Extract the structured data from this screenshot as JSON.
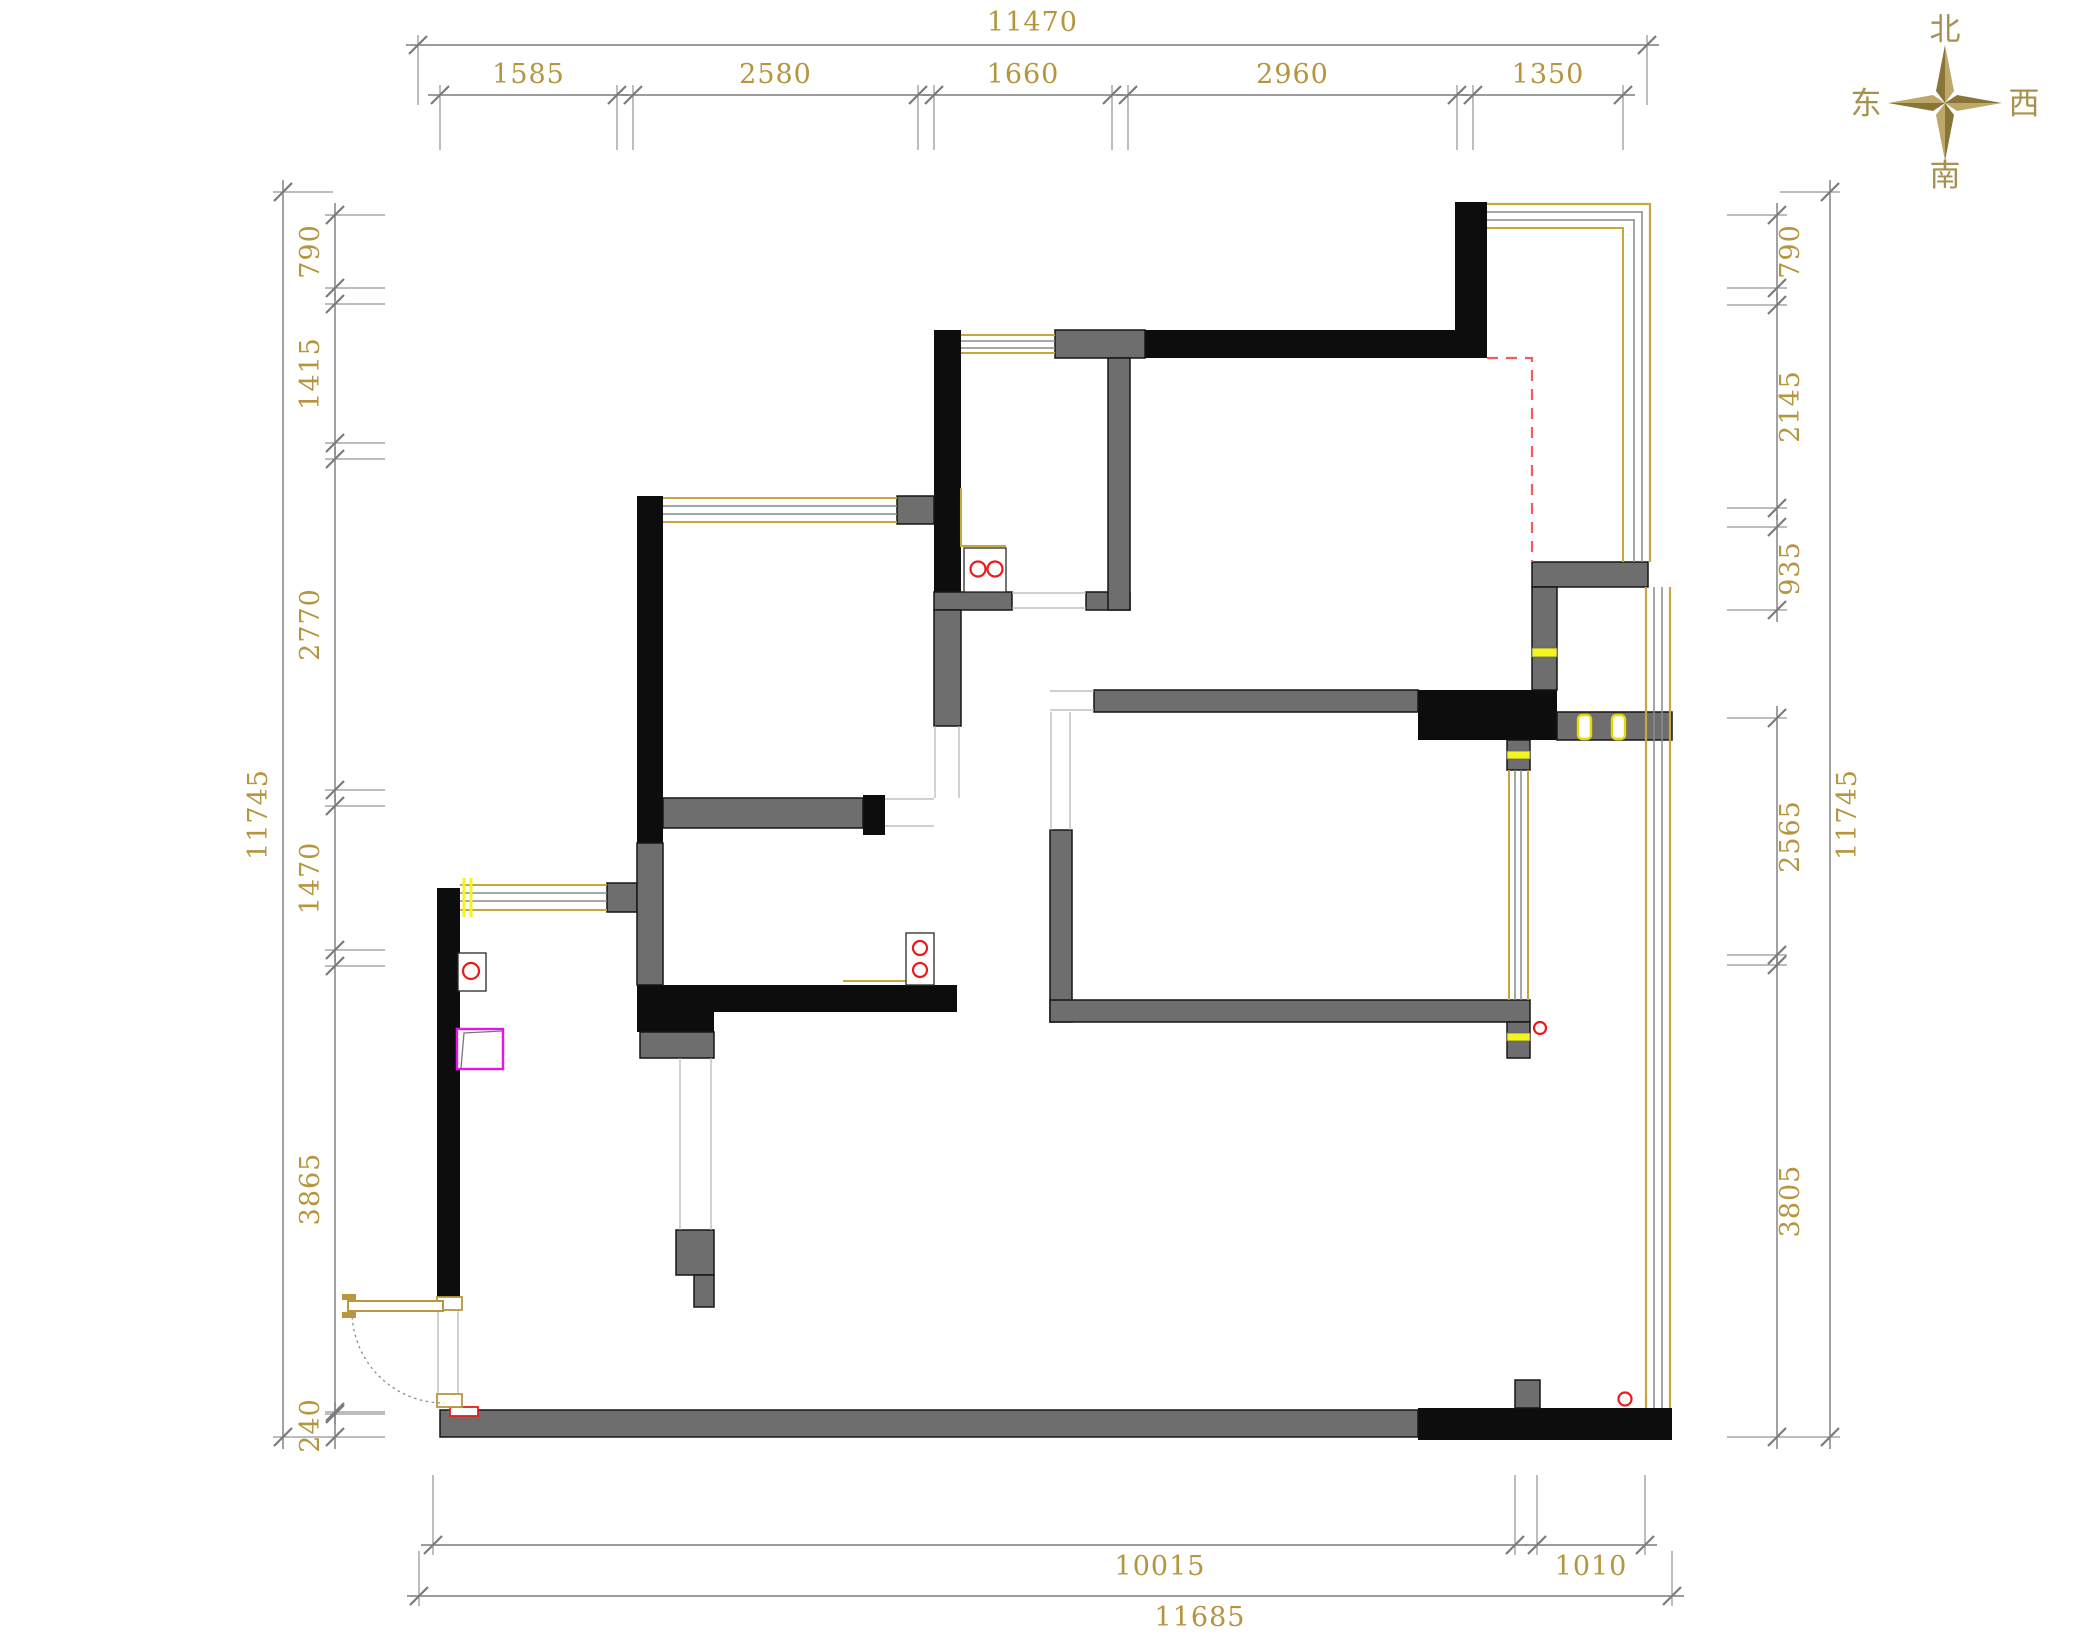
{
  "page": {
    "width": 2096,
    "height": 1637,
    "background": "#ffffff",
    "drawing_type": "apartment floor plan"
  },
  "palette": {
    "dim_line": "#7b7b7b",
    "dim_text": "#b5953e",
    "wall_black": "#0d0d0d",
    "wall_gray": "#6e6e6e",
    "window_gold": "#c9a63d",
    "window_gray": "#8a8a8a",
    "mark_yellow": "#f5f51e",
    "mark_red": "#e81c1c",
    "mark_magenta": "#e813e8",
    "dashed_red": "#f25c5c"
  },
  "compass": {
    "labels": {
      "north": "北",
      "south": "南",
      "east": "东",
      "west": "西"
    },
    "color": "#a8914f",
    "star_dark": "#8a7539",
    "star_light": "#bda86a"
  },
  "dimensions": {
    "chains": [
      {
        "id": "top-total",
        "orient": "h",
        "line": 45,
        "ext": 60,
        "toff": -14,
        "spans": [
          {
            "from": 418,
            "to": 1647,
            "label": "11470"
          }
        ]
      },
      {
        "id": "top-segments",
        "orient": "h",
        "line": 95,
        "ext": 55,
        "toff": -12,
        "spans": [
          {
            "from": 440,
            "to": 617,
            "label": "1585"
          },
          {
            "from": 633,
            "to": 918,
            "label": "2580"
          },
          {
            "from": 934,
            "to": 1112,
            "label": "1660"
          },
          {
            "from": 1128,
            "to": 1457,
            "label": "2960"
          },
          {
            "from": 1473,
            "to": 1623,
            "label": "1350"
          }
        ]
      },
      {
        "id": "left-total",
        "orient": "v",
        "line": 283,
        "ext": 50,
        "toff": -16,
        "spans": [
          {
            "from": 192,
            "to": 1437,
            "label": "11745"
          }
        ]
      },
      {
        "id": "left-segments",
        "orient": "v",
        "line": 335,
        "ext": 50,
        "toff": -16,
        "spans": [
          {
            "from": 215,
            "to": 288,
            "label": "790"
          },
          {
            "from": 304,
            "to": 443,
            "label": "1415"
          },
          {
            "from": 459,
            "to": 790,
            "label": "2770"
          },
          {
            "from": 806,
            "to": 950,
            "label": "1470"
          },
          {
            "from": 966,
            "to": 1412,
            "label": "3865"
          },
          {
            "from": 1414,
            "to": 1437,
            "label": "240"
          }
        ]
      },
      {
        "id": "right-segments",
        "orient": "v",
        "line": 1777,
        "ext": -50,
        "toff": 22,
        "spans": [
          {
            "from": 215,
            "to": 288,
            "label": "790"
          },
          {
            "from": 305,
            "to": 508,
            "label": "2145"
          },
          {
            "from": 527,
            "to": 610,
            "label": "935"
          },
          {
            "from": 718,
            "to": 955,
            "label": "2565"
          },
          {
            "from": 965,
            "to": 1437,
            "label": "3805"
          }
        ]
      },
      {
        "id": "right-total",
        "orient": "v",
        "line": 1830,
        "ext": -50,
        "toff": 26,
        "spans": [
          {
            "from": 192,
            "to": 1437,
            "label": "11745"
          }
        ]
      },
      {
        "id": "bottom-segments",
        "orient": "h",
        "line": 1545,
        "ext": -70,
        "toff": 30,
        "spans": [
          {
            "from": 433,
            "to": 1515,
            "label": "10015",
            "tx": 1160
          },
          {
            "from": 1537,
            "to": 1645,
            "label": "1010"
          }
        ]
      },
      {
        "id": "bottom-total",
        "orient": "h",
        "line": 1596,
        "ext": -45,
        "toff": 30,
        "spans": [
          {
            "from": 419,
            "to": 1672,
            "label": "11685",
            "tx": 1200
          }
        ]
      }
    ]
  }
}
